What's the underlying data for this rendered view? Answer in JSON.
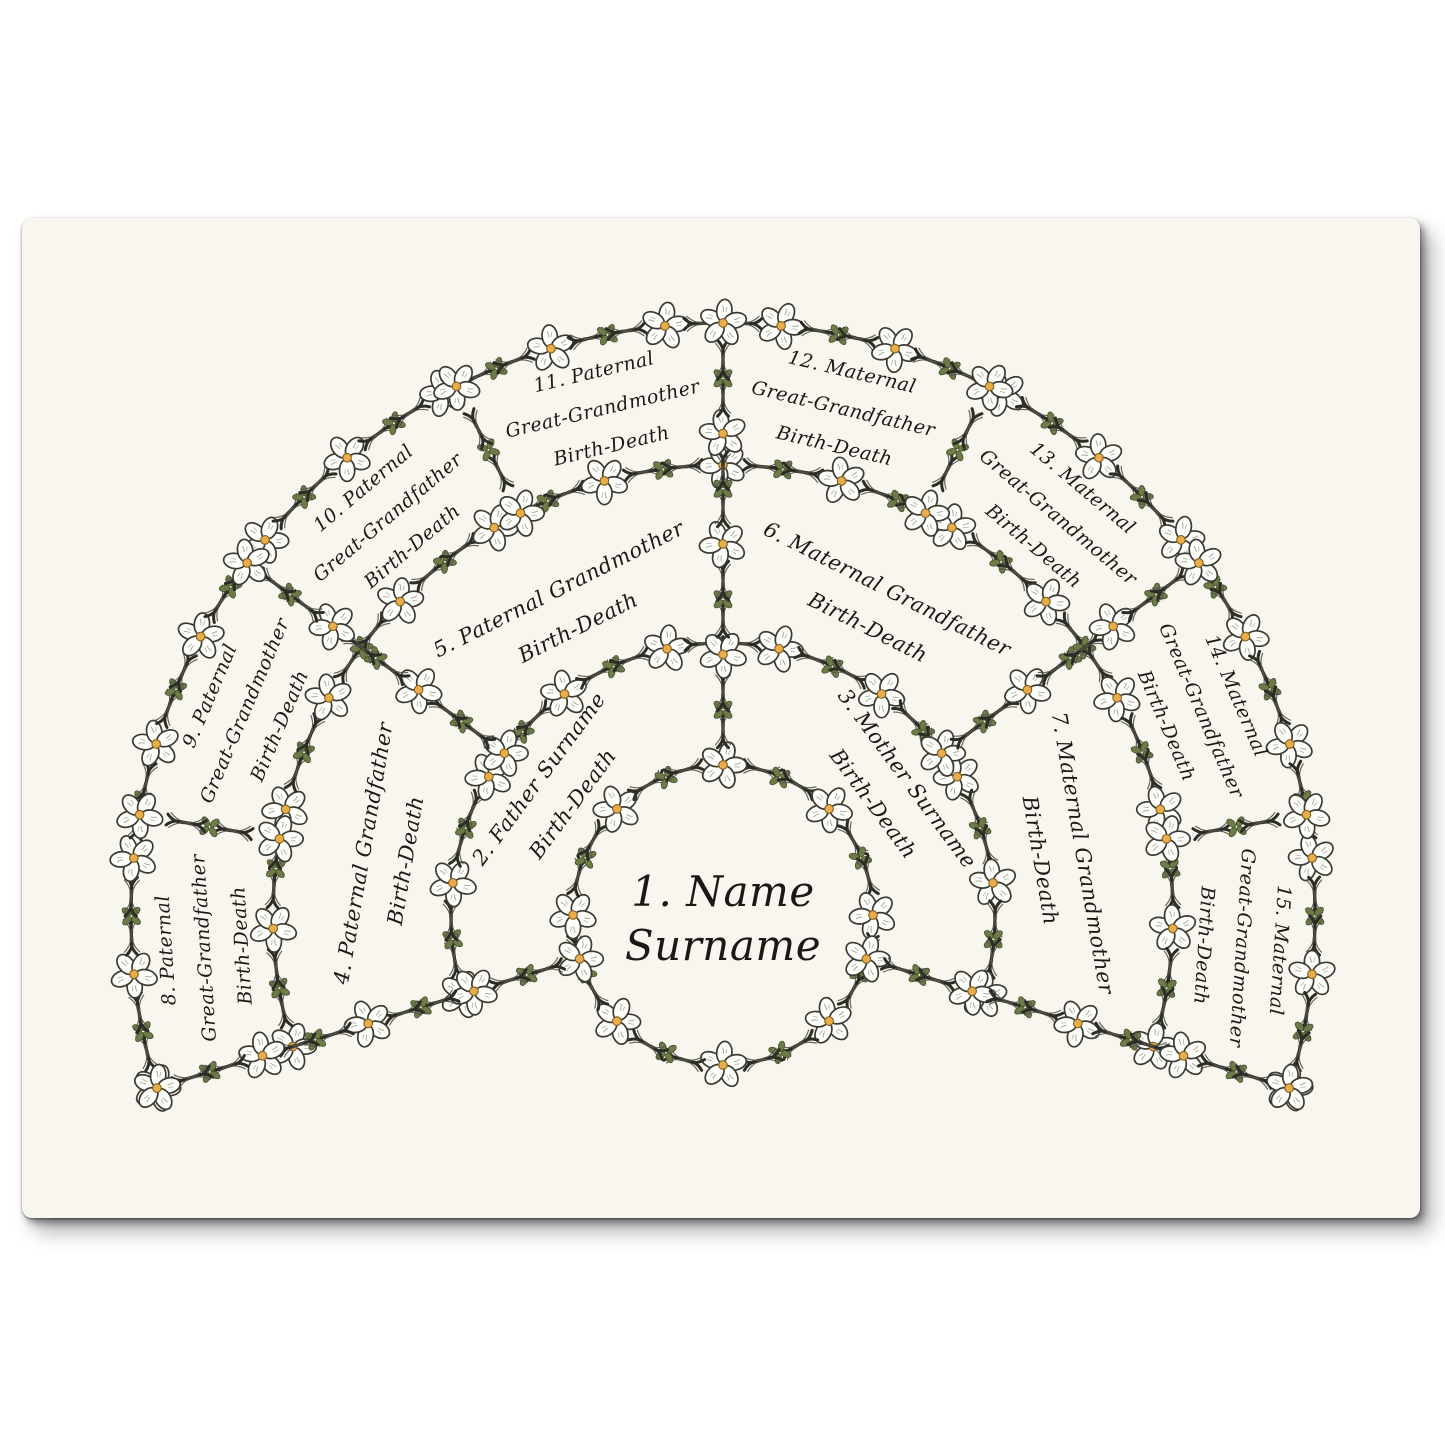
{
  "page": {
    "background": "#ffffff",
    "poster_paper": "#f8f6ef"
  },
  "colors": {
    "ink_text": "#1b1915",
    "vine": "#2d2d27",
    "vine_light": "#55554c",
    "leaf": "#6d7b48",
    "leaf_outline": "#44502a",
    "petal": "#fdfdfa",
    "petal_outline": "#3b3b33",
    "petal_vein": "#8d8d81",
    "flower_center": "#e9ae49",
    "flower_center_outline": "#7f6024"
  },
  "fan": {
    "center": {
      "id": 1,
      "lines": [
        "1. Name",
        "Surname"
      ]
    },
    "rings": [
      {
        "generation": "parents",
        "slices": [
          {
            "id": 2,
            "lines": [
              "2. Father Surname",
              "Birth-Death"
            ]
          },
          {
            "id": 3,
            "lines": [
              "3. Mother Surname",
              "Birth-Death"
            ]
          }
        ]
      },
      {
        "generation": "grandparents",
        "slices": [
          {
            "id": 4,
            "lines": [
              "4. Paternal Grandfather",
              "Birth-Death"
            ]
          },
          {
            "id": 5,
            "lines": [
              "5. Paternal Grandmother",
              "Birth-Death"
            ]
          },
          {
            "id": 6,
            "lines": [
              "6. Maternal Grandfather",
              "Birth-Death"
            ]
          },
          {
            "id": 7,
            "lines": [
              "7. Maternal Grandmother",
              "Birth-Death"
            ]
          }
        ]
      },
      {
        "generation": "great-grandparents",
        "slices": [
          {
            "id": 8,
            "lines": [
              "8. Paternal",
              "Great-Grandfather",
              "Birth-Death"
            ]
          },
          {
            "id": 9,
            "lines": [
              "9. Paternal",
              "Great-Grandmother",
              "Birth-Death"
            ]
          },
          {
            "id": 10,
            "lines": [
              "10. Paternal",
              "Great-Grandfather",
              "Birth-Death"
            ]
          },
          {
            "id": 11,
            "lines": [
              "11. Paternal",
              "Great-Grandmother",
              "Birth-Death"
            ]
          },
          {
            "id": 12,
            "lines": [
              "12. Maternal",
              "Great-Grandfather",
              "Birth-Death"
            ]
          },
          {
            "id": 13,
            "lines": [
              "13. Maternal",
              "Great-Grandmother",
              "Birth-Death"
            ]
          },
          {
            "id": 14,
            "lines": [
              "14. Maternal",
              "Great-Grandfather",
              "Birth-Death"
            ]
          },
          {
            "id": 15,
            "lines": [
              "15. Maternal",
              "Great-Grandmother",
              "Birth-Death"
            ]
          }
        ]
      }
    ]
  }
}
